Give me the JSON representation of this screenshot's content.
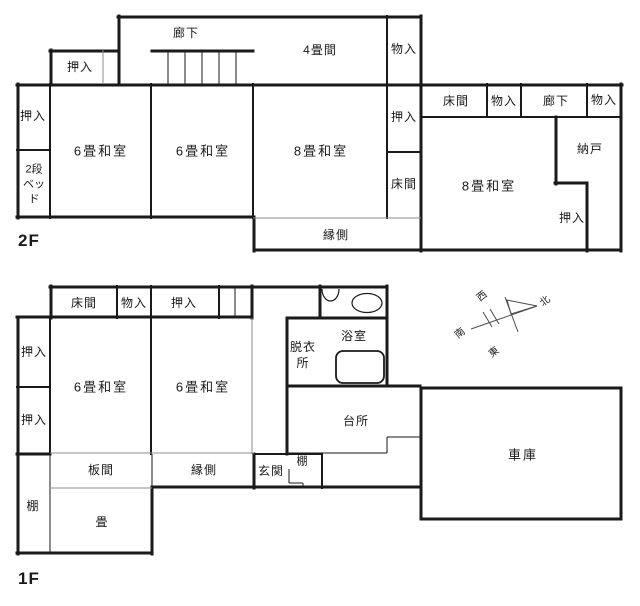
{
  "colors": {
    "wall": "#1a1a1a",
    "light_line": "#8c8c8c",
    "text": "#1a1a1a",
    "background": "#ffffff"
  },
  "floor2": {
    "floor_label": "2F",
    "corridor_top": "廊下",
    "closet_upper": "押入",
    "room_4tatami": "4畳間",
    "storage_upper": "物入",
    "closet_left": "押入",
    "bunk_bed_lines": [
      "2段",
      "ベッ",
      "ド"
    ],
    "washitsu6_a": "6畳和室",
    "washitsu6_b": "6畳和室",
    "washitsu8_a": "8畳和室",
    "closet_mid": "押入",
    "alcove_mid": "床間",
    "alcove_right": "床間",
    "storage_right_a": "物入",
    "corridor_right": "廊下",
    "storage_right_b": "物入",
    "washitsu8_b": "8畳和室",
    "storeroom": "納戸",
    "closet_right": "押入",
    "veranda": "縁側"
  },
  "floor1": {
    "floor_label": "1F",
    "alcove": "床間",
    "storage": "物入",
    "closet_top": "押入",
    "closet_left_a": "押入",
    "closet_left_b": "押入",
    "washitsu6_a": "6畳和室",
    "washitsu6_b": "6畳和室",
    "shelf_left": "棚",
    "wood_floor": "板間",
    "tatami": "畳",
    "veranda": "縁側",
    "entrance": "玄関",
    "shelf_entrance": "棚",
    "dressing_room_lines": [
      "脱衣",
      "所"
    ],
    "bathroom": "浴室",
    "kitchen": "台所",
    "garage": "車庫"
  },
  "compass": {
    "north": "北",
    "south": "南",
    "east": "東",
    "west": "西"
  }
}
